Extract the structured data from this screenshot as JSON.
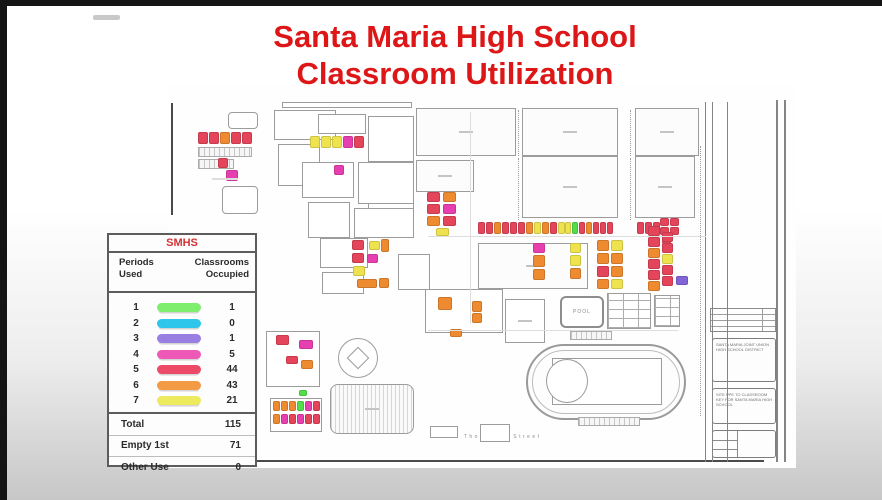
{
  "slide": {
    "title_line1": "Santa Maria High School",
    "title_line2": "Classroom Utilization",
    "title_color": "#dd1717"
  },
  "legend": {
    "school": "SMHS",
    "col_periods_1": "Periods",
    "col_periods_2": "Used",
    "col_class_1": "Classrooms",
    "col_class_2": "Occupied",
    "rows": [
      {
        "period": "1",
        "count": "1",
        "color": "#7fee6e"
      },
      {
        "period": "2",
        "count": "0",
        "color": "#2ec6ea"
      },
      {
        "period": "3",
        "count": "1",
        "color": "#9a7fe2"
      },
      {
        "period": "4",
        "count": "5",
        "color": "#ee59b8"
      },
      {
        "period": "5",
        "count": "44",
        "color": "#ec4a66"
      },
      {
        "period": "6",
        "count": "43",
        "color": "#f29a44"
      },
      {
        "period": "7",
        "count": "21",
        "color": "#eeea5e"
      }
    ],
    "summary": [
      {
        "label": "Total",
        "value": "115"
      },
      {
        "label": "Empty 1st",
        "value": "71"
      },
      {
        "label": "Other Use",
        "value": "0"
      }
    ]
  },
  "map": {
    "street_label": "South Thornburg Street",
    "pool_label": "POOL",
    "title_block_text1": "Santa Maria Joint Union High School District",
    "title_block_text2": "Site PPE to Classroom Key for Santa Maria High School",
    "palette": {
      "R": "#e4455a",
      "O": "#ee8a30",
      "Y": "#eee34e",
      "P": "#e83fb0",
      "G": "#53dd4b",
      "V": "#8165d6"
    },
    "buildings": [
      [
        60,
        26,
        30,
        17,
        "r"
      ],
      [
        114,
        16,
        130,
        6,
        "b"
      ],
      [
        106,
        24,
        62,
        30,
        "b"
      ],
      [
        150,
        28,
        48,
        20,
        "b"
      ],
      [
        110,
        58,
        42,
        42,
        "b"
      ],
      [
        200,
        30,
        46,
        46,
        "b"
      ],
      [
        200,
        78,
        46,
        72,
        "b"
      ],
      [
        134,
        76,
        52,
        36,
        "b"
      ],
      [
        190,
        76,
        56,
        42,
        "b"
      ],
      [
        140,
        116,
        42,
        36,
        "b"
      ],
      [
        186,
        122,
        60,
        30,
        "b"
      ],
      [
        54,
        100,
        36,
        28,
        "r"
      ],
      [
        248,
        22,
        100,
        48,
        "f"
      ],
      [
        354,
        22,
        96,
        48,
        "f"
      ],
      [
        467,
        22,
        64,
        48,
        "f"
      ],
      [
        248,
        74,
        58,
        32,
        "f"
      ],
      [
        354,
        70,
        96,
        62,
        "f"
      ],
      [
        467,
        70,
        60,
        62,
        "f"
      ],
      [
        310,
        157,
        110,
        46,
        "f"
      ],
      [
        152,
        152,
        48,
        30,
        "b"
      ],
      [
        154,
        186,
        42,
        22,
        "b"
      ],
      [
        230,
        168,
        32,
        36,
        "b"
      ],
      [
        257,
        203,
        78,
        44,
        "b"
      ],
      [
        337,
        213,
        40,
        44,
        "d"
      ],
      [
        439,
        207,
        44,
        36,
        "g"
      ],
      [
        486,
        209,
        26,
        32,
        "g"
      ],
      [
        402,
        245,
        42,
        9,
        "h"
      ],
      [
        30,
        61,
        54,
        10,
        "h"
      ],
      [
        30,
        73,
        36,
        10,
        "h"
      ],
      [
        162,
        298,
        84,
        50,
        "p"
      ],
      [
        98,
        245,
        54,
        56,
        "b"
      ],
      [
        102,
        312,
        52,
        34,
        "b"
      ],
      [
        312,
        338,
        30,
        18,
        "b"
      ],
      [
        262,
        340,
        28,
        12,
        "b"
      ],
      [
        358,
        258,
        160,
        76,
        "t"
      ],
      [
        384,
        272,
        110,
        47,
        "b"
      ],
      [
        378,
        273,
        42,
        44,
        "e"
      ],
      [
        410,
        331,
        62,
        9,
        "h"
      ],
      [
        170,
        252,
        40,
        40,
        "e"
      ],
      [
        182,
        264,
        16,
        16,
        "q"
      ]
    ],
    "blocks": [
      [
        30,
        46,
        10,
        12,
        "R"
      ],
      [
        41,
        46,
        10,
        12,
        "R"
      ],
      [
        52,
        46,
        10,
        12,
        "O"
      ],
      [
        63,
        46,
        10,
        12,
        "R"
      ],
      [
        74,
        46,
        10,
        12,
        "R"
      ],
      [
        50,
        72,
        10,
        10,
        "R"
      ],
      [
        58,
        84,
        12,
        11,
        "P"
      ],
      [
        142,
        50,
        10,
        12,
        "Y"
      ],
      [
        153,
        50,
        10,
        12,
        "Y"
      ],
      [
        164,
        50,
        10,
        12,
        "Y"
      ],
      [
        175,
        50,
        10,
        12,
        "P"
      ],
      [
        186,
        50,
        10,
        12,
        "R"
      ],
      [
        166,
        79,
        10,
        10,
        "P"
      ],
      [
        259,
        106,
        13,
        10,
        "R"
      ],
      [
        275,
        106,
        13,
        10,
        "O"
      ],
      [
        259,
        118,
        13,
        10,
        "R"
      ],
      [
        275,
        118,
        13,
        10,
        "P"
      ],
      [
        259,
        130,
        13,
        10,
        "O"
      ],
      [
        275,
        130,
        13,
        10,
        "R"
      ],
      [
        268,
        142,
        13,
        8,
        "Y"
      ],
      [
        184,
        154,
        12,
        10,
        "R"
      ],
      [
        201,
        155,
        11,
        9,
        "Y"
      ],
      [
        213,
        153,
        8,
        13,
        "O"
      ],
      [
        184,
        167,
        12,
        10,
        "R"
      ],
      [
        199,
        168,
        11,
        9,
        "P"
      ],
      [
        185,
        180,
        12,
        10,
        "Y"
      ],
      [
        189,
        193,
        20,
        9,
        "O"
      ],
      [
        211,
        192,
        10,
        10,
        "O"
      ],
      [
        270,
        211,
        14,
        13,
        "O"
      ],
      [
        304,
        215,
        10,
        11,
        "O"
      ],
      [
        304,
        227,
        10,
        10,
        "O"
      ],
      [
        282,
        243,
        12,
        8,
        "O"
      ],
      [
        310,
        136,
        7,
        12,
        "R"
      ],
      [
        318,
        136,
        7,
        12,
        "R"
      ],
      [
        326,
        136,
        7,
        12,
        "O"
      ],
      [
        334,
        136,
        7,
        12,
        "R"
      ],
      [
        342,
        136,
        7,
        12,
        "R"
      ],
      [
        350,
        136,
        7,
        12,
        "R"
      ],
      [
        358,
        136,
        7,
        12,
        "O"
      ],
      [
        366,
        136,
        7,
        12,
        "Y"
      ],
      [
        374,
        136,
        7,
        12,
        "O"
      ],
      [
        382,
        136,
        7,
        12,
        "R"
      ],
      [
        390,
        136,
        7,
        12,
        "Y"
      ],
      [
        397,
        136,
        6,
        12,
        "Y"
      ],
      [
        404,
        136,
        6,
        12,
        "G"
      ],
      [
        411,
        136,
        6,
        12,
        "R"
      ],
      [
        418,
        136,
        6,
        12,
        "O"
      ],
      [
        425,
        136,
        6,
        12,
        "R"
      ],
      [
        432,
        136,
        6,
        12,
        "R"
      ],
      [
        439,
        136,
        6,
        12,
        "R"
      ],
      [
        469,
        136,
        7,
        12,
        "R"
      ],
      [
        477,
        136,
        7,
        12,
        "R"
      ],
      [
        485,
        136,
        7,
        12,
        "R"
      ],
      [
        492,
        132,
        9,
        8,
        "R"
      ],
      [
        502,
        132,
        9,
        8,
        "R"
      ],
      [
        492,
        141,
        9,
        8,
        "R"
      ],
      [
        502,
        141,
        9,
        8,
        "R"
      ],
      [
        494,
        150,
        9,
        8,
        "R"
      ],
      [
        365,
        157,
        12,
        10,
        "P"
      ],
      [
        365,
        169,
        12,
        12,
        "O"
      ],
      [
        365,
        183,
        12,
        11,
        "O"
      ],
      [
        402,
        157,
        11,
        10,
        "Y"
      ],
      [
        402,
        169,
        11,
        11,
        "Y"
      ],
      [
        402,
        182,
        11,
        11,
        "O"
      ],
      [
        429,
        154,
        12,
        11,
        "O"
      ],
      [
        443,
        154,
        12,
        11,
        "Y"
      ],
      [
        429,
        167,
        12,
        11,
        "O"
      ],
      [
        443,
        167,
        12,
        11,
        "O"
      ],
      [
        429,
        180,
        12,
        11,
        "R"
      ],
      [
        443,
        180,
        12,
        11,
        "O"
      ],
      [
        429,
        193,
        12,
        10,
        "O"
      ],
      [
        443,
        193,
        12,
        10,
        "Y"
      ],
      [
        480,
        140,
        12,
        10,
        "R"
      ],
      [
        480,
        151,
        12,
        10,
        "R"
      ],
      [
        480,
        162,
        12,
        10,
        "O"
      ],
      [
        480,
        173,
        12,
        10,
        "R"
      ],
      [
        480,
        184,
        12,
        10,
        "R"
      ],
      [
        480,
        195,
        12,
        10,
        "O"
      ],
      [
        494,
        146,
        11,
        10,
        "R"
      ],
      [
        494,
        157,
        11,
        10,
        "R"
      ],
      [
        494,
        168,
        11,
        10,
        "Y"
      ],
      [
        494,
        179,
        11,
        10,
        "R"
      ],
      [
        494,
        190,
        11,
        10,
        "R"
      ],
      [
        508,
        190,
        12,
        9,
        "V"
      ],
      [
        108,
        249,
        13,
        10,
        "R"
      ],
      [
        131,
        254,
        14,
        9,
        "P"
      ],
      [
        118,
        270,
        12,
        8,
        "R"
      ],
      [
        133,
        274,
        12,
        9,
        "O"
      ],
      [
        131,
        304,
        8,
        6,
        "G"
      ],
      [
        105,
        315,
        7,
        10,
        "O"
      ],
      [
        113,
        315,
        7,
        10,
        "O"
      ],
      [
        121,
        315,
        7,
        10,
        "O"
      ],
      [
        129,
        315,
        7,
        10,
        "G"
      ],
      [
        137,
        315,
        7,
        10,
        "P"
      ],
      [
        145,
        315,
        7,
        10,
        "R"
      ],
      [
        105,
        328,
        7,
        10,
        "O"
      ],
      [
        113,
        328,
        7,
        10,
        "P"
      ],
      [
        121,
        328,
        7,
        10,
        "R"
      ],
      [
        129,
        328,
        7,
        10,
        "P"
      ],
      [
        137,
        328,
        7,
        10,
        "R"
      ],
      [
        145,
        328,
        7,
        10,
        "R"
      ]
    ],
    "lines": [
      [
        3,
        17,
        2,
        112,
        "dk"
      ],
      [
        0,
        374,
        596,
        2,
        "dk"
      ],
      [
        537,
        16,
        1,
        360,
        "md"
      ],
      [
        544,
        16,
        1,
        360,
        "md"
      ],
      [
        559,
        16,
        1,
        360,
        "md"
      ],
      [
        608,
        14,
        2,
        362,
        "md"
      ],
      [
        616,
        14,
        2,
        362,
        "md"
      ],
      [
        532,
        60,
        1,
        270,
        "dot"
      ],
      [
        350,
        24,
        1,
        46,
        "dot"
      ],
      [
        462,
        24,
        1,
        46,
        "dot"
      ],
      [
        350,
        72,
        1,
        62,
        "dot"
      ],
      [
        462,
        72,
        1,
        62,
        "dot"
      ],
      [
        302,
        26,
        1,
        212,
        "ft"
      ],
      [
        260,
        150,
        278,
        1,
        "ft"
      ],
      [
        260,
        244,
        250,
        1,
        "ft"
      ],
      [
        44,
        92,
        26,
        2,
        "ft"
      ]
    ]
  }
}
